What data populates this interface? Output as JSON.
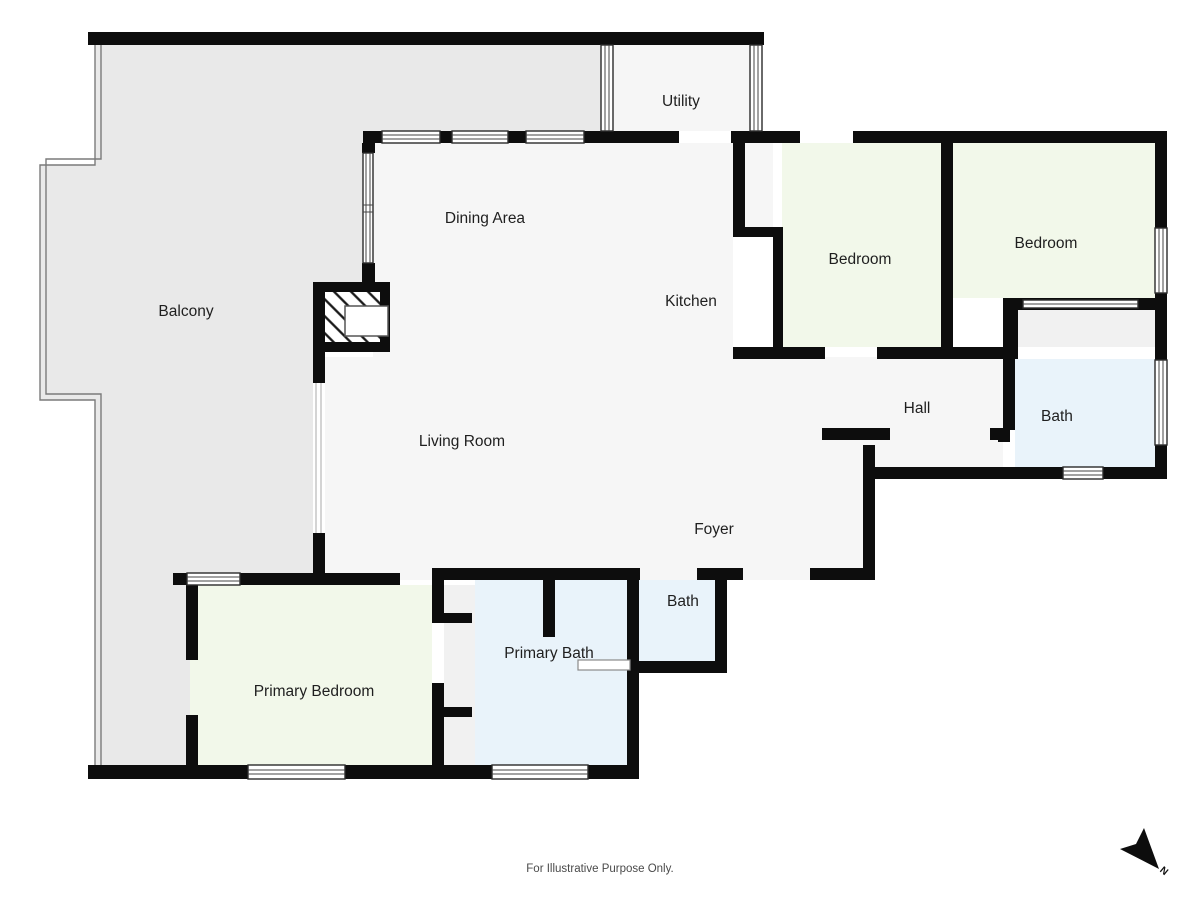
{
  "plan": {
    "footer_note": "For Illustrative Purpose Only.",
    "compass_label": "N",
    "colors": {
      "wall": "#0d0d0d",
      "balcony_fill": "#e9e9e9",
      "interior_floor": "#f6f6f6",
      "bedroom_fill": "#f2f8ea",
      "bath_fill": "#e9f3fa",
      "closet_fill": "#f1f1f1",
      "window_stroke": "#2b2b2b"
    },
    "rooms": {
      "balcony": {
        "label": "Balcony"
      },
      "utility": {
        "label": "Utility"
      },
      "dining": {
        "label": "Dining Area"
      },
      "kitchen": {
        "label": "Kitchen"
      },
      "bedroom_1": {
        "label": "Bedroom"
      },
      "bedroom_2": {
        "label": "Bedroom"
      },
      "hall": {
        "label": "Hall"
      },
      "bath_1": {
        "label": "Bath"
      },
      "living": {
        "label": "Living Room"
      },
      "foyer": {
        "label": "Foyer"
      },
      "bath_2": {
        "label": "Bath"
      },
      "primary_bath": {
        "label": "Primary Bath"
      },
      "primary_bedroom": {
        "label": "Primary Bedroom"
      }
    }
  }
}
